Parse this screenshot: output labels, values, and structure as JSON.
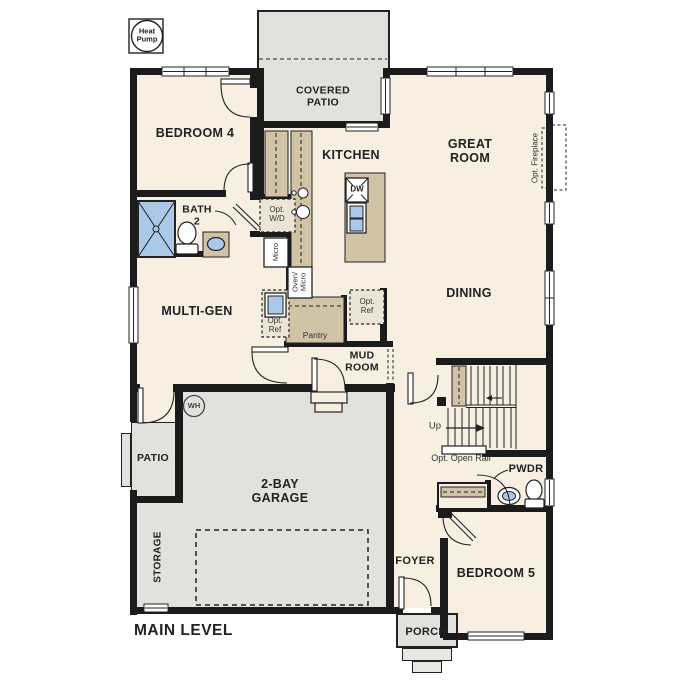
{
  "plan": {
    "title": "MAIN LEVEL",
    "colors": {
      "wall": "#1b1b1b",
      "floor": "#f6efe2",
      "concrete": "#e1e1de",
      "counter": "#d0c3a6",
      "fixture_blue": "#aac9e9"
    },
    "rooms": {
      "bedroom4": "BEDROOM 4",
      "kitchen": "KITCHEN",
      "great_room": "GREAT\nROOM",
      "dining": "DINING",
      "multi_gen": "MULTI-GEN",
      "bath2": "BATH\n2",
      "mud_room": "MUD\nROOM",
      "covered_patio": "COVERED\nPATIO",
      "patio": "PATIO",
      "garage": "2-BAY\nGARAGE",
      "storage": "STORAGE",
      "foyer": "FOYER",
      "bedroom5": "BEDROOM 5",
      "porch": "PORCH",
      "pwdr": "PWDR",
      "pantry": "Pantry"
    },
    "annotations": {
      "heat_pump": "Heat\nPump",
      "opt_fireplace": "Opt. Fireplace",
      "opt_wd": "Opt.\nW/D",
      "micro": "Micro",
      "oven_micro": "Oven/\nMicro",
      "opt_ref_left": "Opt.\nRef",
      "opt_ref_right": "Opt.\nRef",
      "up": "Up",
      "opt_open_rail": "Opt. Open Rail",
      "wh": "WH",
      "dw": "DW"
    }
  }
}
